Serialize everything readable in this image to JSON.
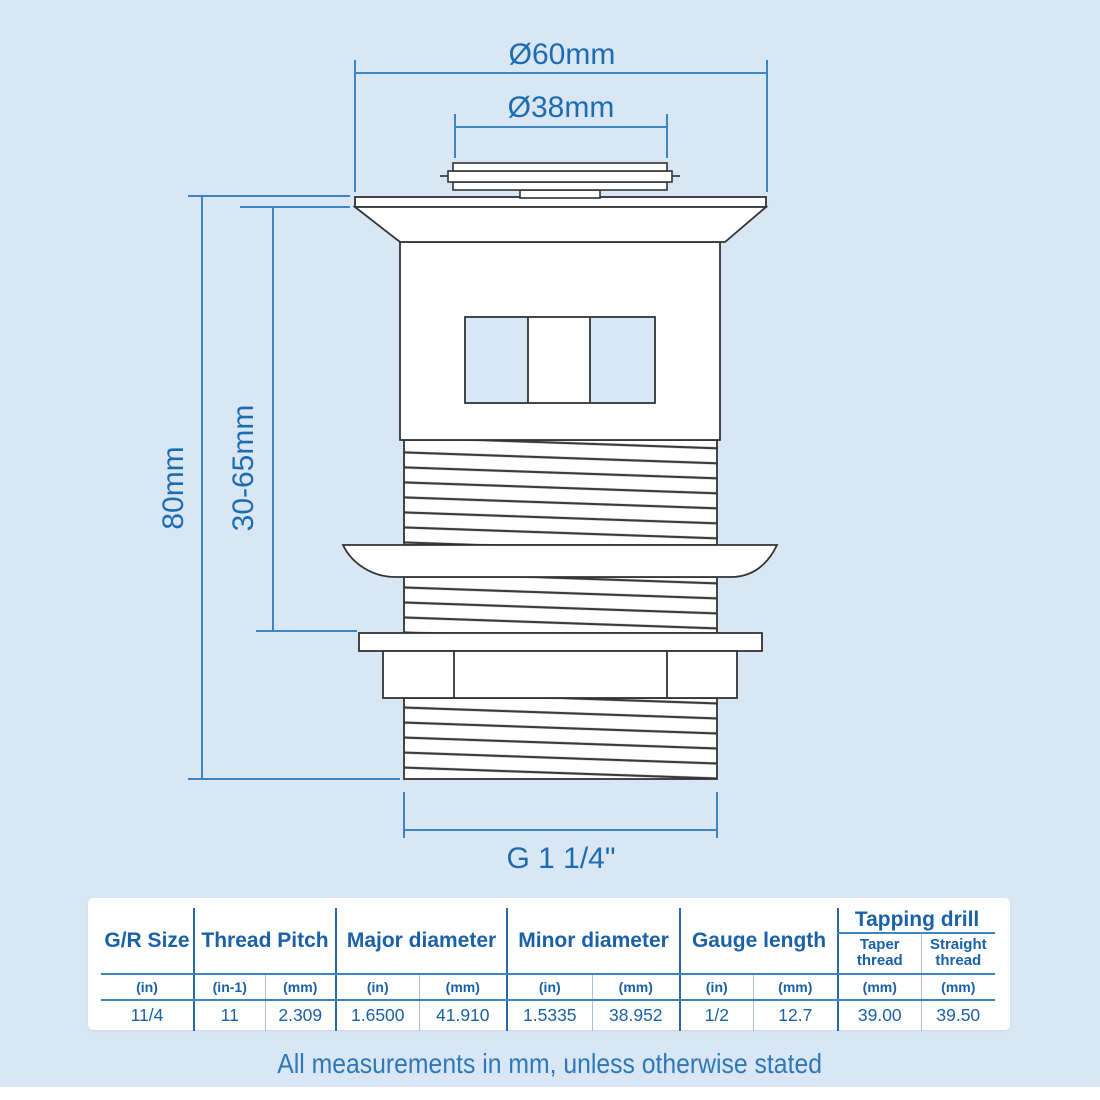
{
  "page": {
    "background_color": "#d9e7f5",
    "dimension_line_color": "#3b86c0",
    "dimension_label_color": "#1e6cb0",
    "drawing_outline_color": "#333333",
    "table_text_color": "#1a61a7"
  },
  "diagram": {
    "dim_top_outer_diameter": "Ø60mm",
    "dim_top_inner_diameter": "Ø38mm",
    "dim_overall_height": "80mm",
    "dim_clamp_range": "30-65mm",
    "dim_thread_size": "G 1 1/4\""
  },
  "table": {
    "headers": {
      "gr_size": "G/R Size",
      "thread_pitch": "Thread Pitch",
      "major_diameter": "Major diameter",
      "minor_diameter": "Minor diameter",
      "gauge_length": "Gauge length",
      "tapping_drill": "Tapping drill",
      "taper_thread": "Taper thread",
      "straight_thread": "Straight thread"
    },
    "units": [
      "(in)",
      "(in-1)",
      "(mm)",
      "(in)",
      "(mm)",
      "(in)",
      "(mm)",
      "(in)",
      "(mm)",
      "(mm)",
      "(mm)"
    ],
    "values": [
      "11/4",
      "11",
      "2.309",
      "1.6500",
      "41.910",
      "1.5335",
      "38.952",
      "1/2",
      "12.7",
      "39.00",
      "39.50"
    ]
  },
  "footer_note": "All measurements in mm, unless otherwise stated"
}
